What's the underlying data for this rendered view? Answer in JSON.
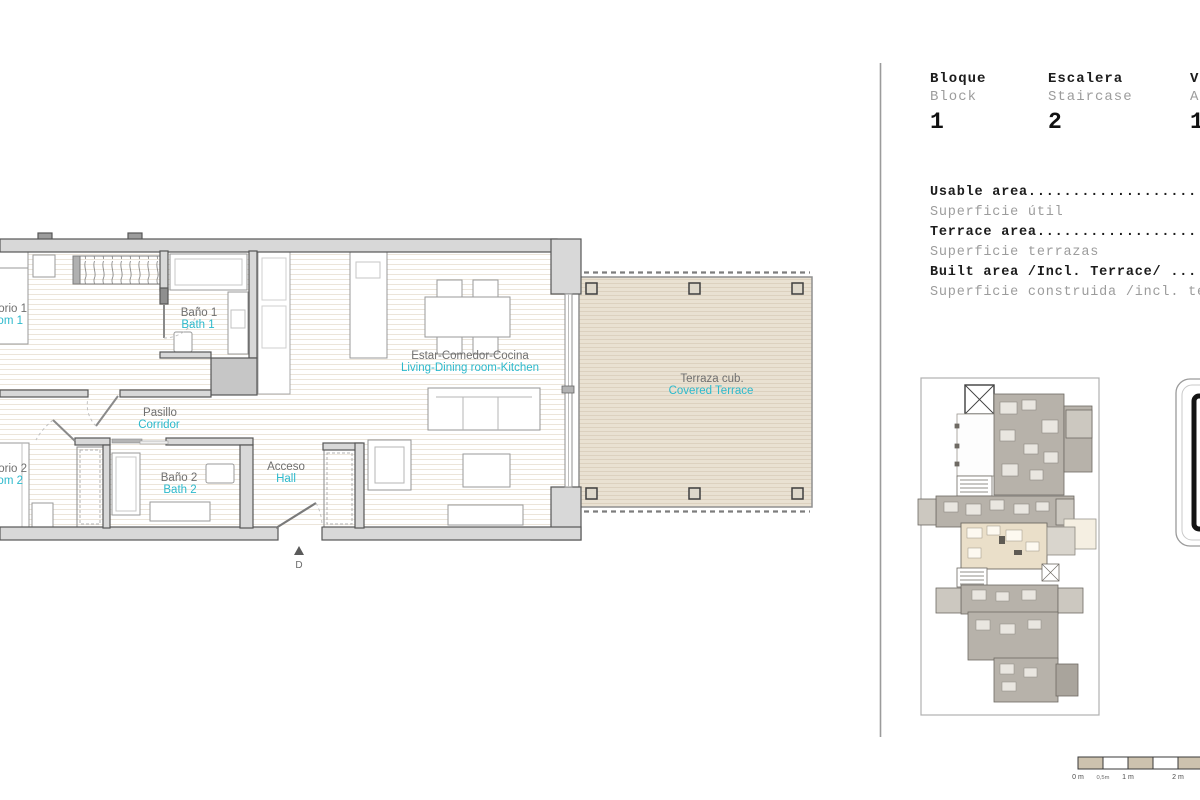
{
  "header": {
    "columns": [
      {
        "title": "Bloque",
        "subtitle": "Block",
        "value": "1"
      },
      {
        "title": "Escalera",
        "subtitle": "Staircase",
        "value": "2"
      },
      {
        "title": "Vivienda",
        "subtitle": "Apartment",
        "value": "1"
      }
    ]
  },
  "areas": {
    "rows": [
      {
        "primary": "Usable area...................................",
        "secondary": "Superficie útil"
      },
      {
        "primary": "Terrace area..................................",
        "secondary": "Superficie terrazas"
      },
      {
        "primary": "Built area /Incl. Terrace/ ...................",
        "secondary": "Superficie construida /incl. terrazas/"
      }
    ]
  },
  "plan": {
    "rooms": {
      "bedroom1": {
        "es": "Dormitorio 1",
        "en": "Bedroom 1"
      },
      "bath1": {
        "es": "Baño 1",
        "en": "Bath 1"
      },
      "corridor": {
        "es": "Pasillo",
        "en": "Corridor"
      },
      "bedroom2": {
        "es": "Dormitorio 2",
        "en": "Bedroom 2"
      },
      "bath2": {
        "es": "Baño 2",
        "en": "Bath 2"
      },
      "hall": {
        "es": "Acceso",
        "en": "Hall"
      },
      "living": {
        "es": "Estar-Comedor-Cocina",
        "en": "Living-Dining room-Kitchen"
      },
      "terrace": {
        "es": "Terraza cub.",
        "en": "Covered Terrace"
      }
    },
    "entrance_marker": "D"
  },
  "scale_bar": {
    "labels": [
      "0 m",
      "0,5m",
      "1 m",
      "2 m"
    ]
  },
  "colors": {
    "accent_cyan": "#2cb9cc",
    "label_gray": "#6f6f6f",
    "wall_fill": "#d8d8d8",
    "terrace_fill": "#e9e1d2",
    "keyplan_gray": "#b7b2aa",
    "highlight_unit": "#eadfc9"
  }
}
